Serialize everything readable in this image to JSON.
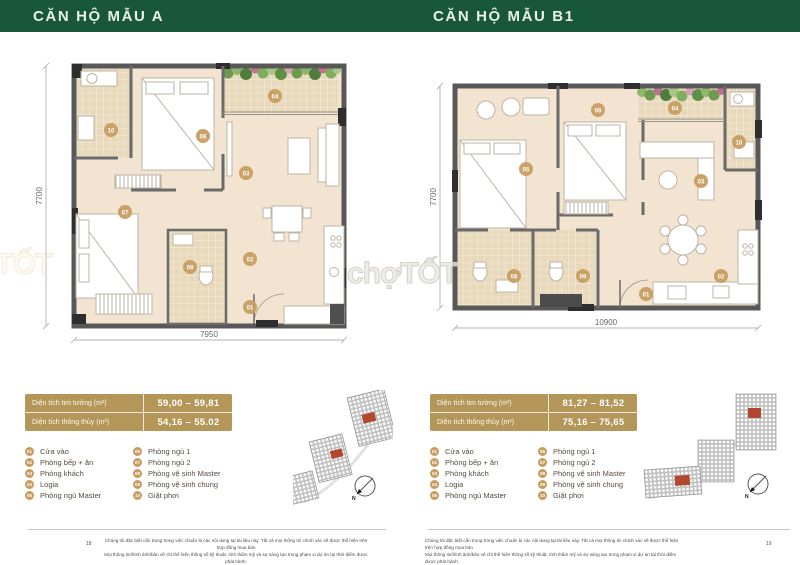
{
  "pages": [
    {
      "title": "CĂN HỘ MẪU A",
      "page_number": "18",
      "dim_width": "7950",
      "dim_height": "7700",
      "area_table": {
        "rows": [
          {
            "label": "Diện tích tim tường (m²)",
            "value": "59,00 – 59,81"
          },
          {
            "label": "Diện tích thông thủy (m²)",
            "value": "54,16 – 55.02"
          }
        ]
      },
      "markers": [
        "10",
        "06",
        "04",
        "03",
        "07",
        "09",
        "02",
        "01"
      ]
    },
    {
      "title": "CĂN HỘ MẪU B1",
      "page_number": "19",
      "dim_width": "10900",
      "dim_height": "7700",
      "area_table": {
        "rows": [
          {
            "label": "Diện tích tim tường (m²)",
            "value": "81,27 – 81,52"
          },
          {
            "label": "Diện tích thông thủy (m²)",
            "value": "75,16 – 75,65"
          }
        ]
      },
      "markers": [
        "05",
        "06",
        "04",
        "10",
        "03",
        "08",
        "09",
        "01",
        "02"
      ]
    }
  ],
  "legend": {
    "col1": [
      {
        "num": "01",
        "label": "Cửa vào"
      },
      {
        "num": "02",
        "label": "Phòng bếp + ăn"
      },
      {
        "num": "03",
        "label": "Phòng khách"
      },
      {
        "num": "04",
        "label": "Logia"
      },
      {
        "num": "05",
        "label": "Phòng ngủ Master"
      }
    ],
    "col2": [
      {
        "num": "06",
        "label": "Phòng ngủ 1"
      },
      {
        "num": "07",
        "label": "Phòng ngủ 2"
      },
      {
        "num": "08",
        "label": "Phòng vệ sinh Master"
      },
      {
        "num": "09",
        "label": "Phòng vệ sinh chung"
      },
      {
        "num": "10",
        "label": "Giặt phơi"
      }
    ]
  },
  "watermark": {
    "text": "chợTỐT"
  },
  "compass": {
    "label": "N"
  },
  "footer": {
    "line1": "Chúng tôi đặc biệt cẩn trọng trong việc chuẩn bị các nội dung tại tài liệu này. Tất cả mọi thông tin chính xác sẽ được thể hiện trên hợp đồng mua bán",
    "line2": "Mọi thông tin/hình ảnh/bản vẽ chỉ thể hiện thông số kỹ thuật, tính thẩm mỹ và sự sáng tạo trong phạm vi dự án tại thời điểm được phát hành."
  },
  "colors": {
    "header_green": "#19573a",
    "table_gold": "#b49659",
    "marker_gold": "#c79c5e",
    "floor_beige": "#f2e4d0",
    "tile_tan": "#e8d8bc",
    "wall_gray": "#585858"
  }
}
